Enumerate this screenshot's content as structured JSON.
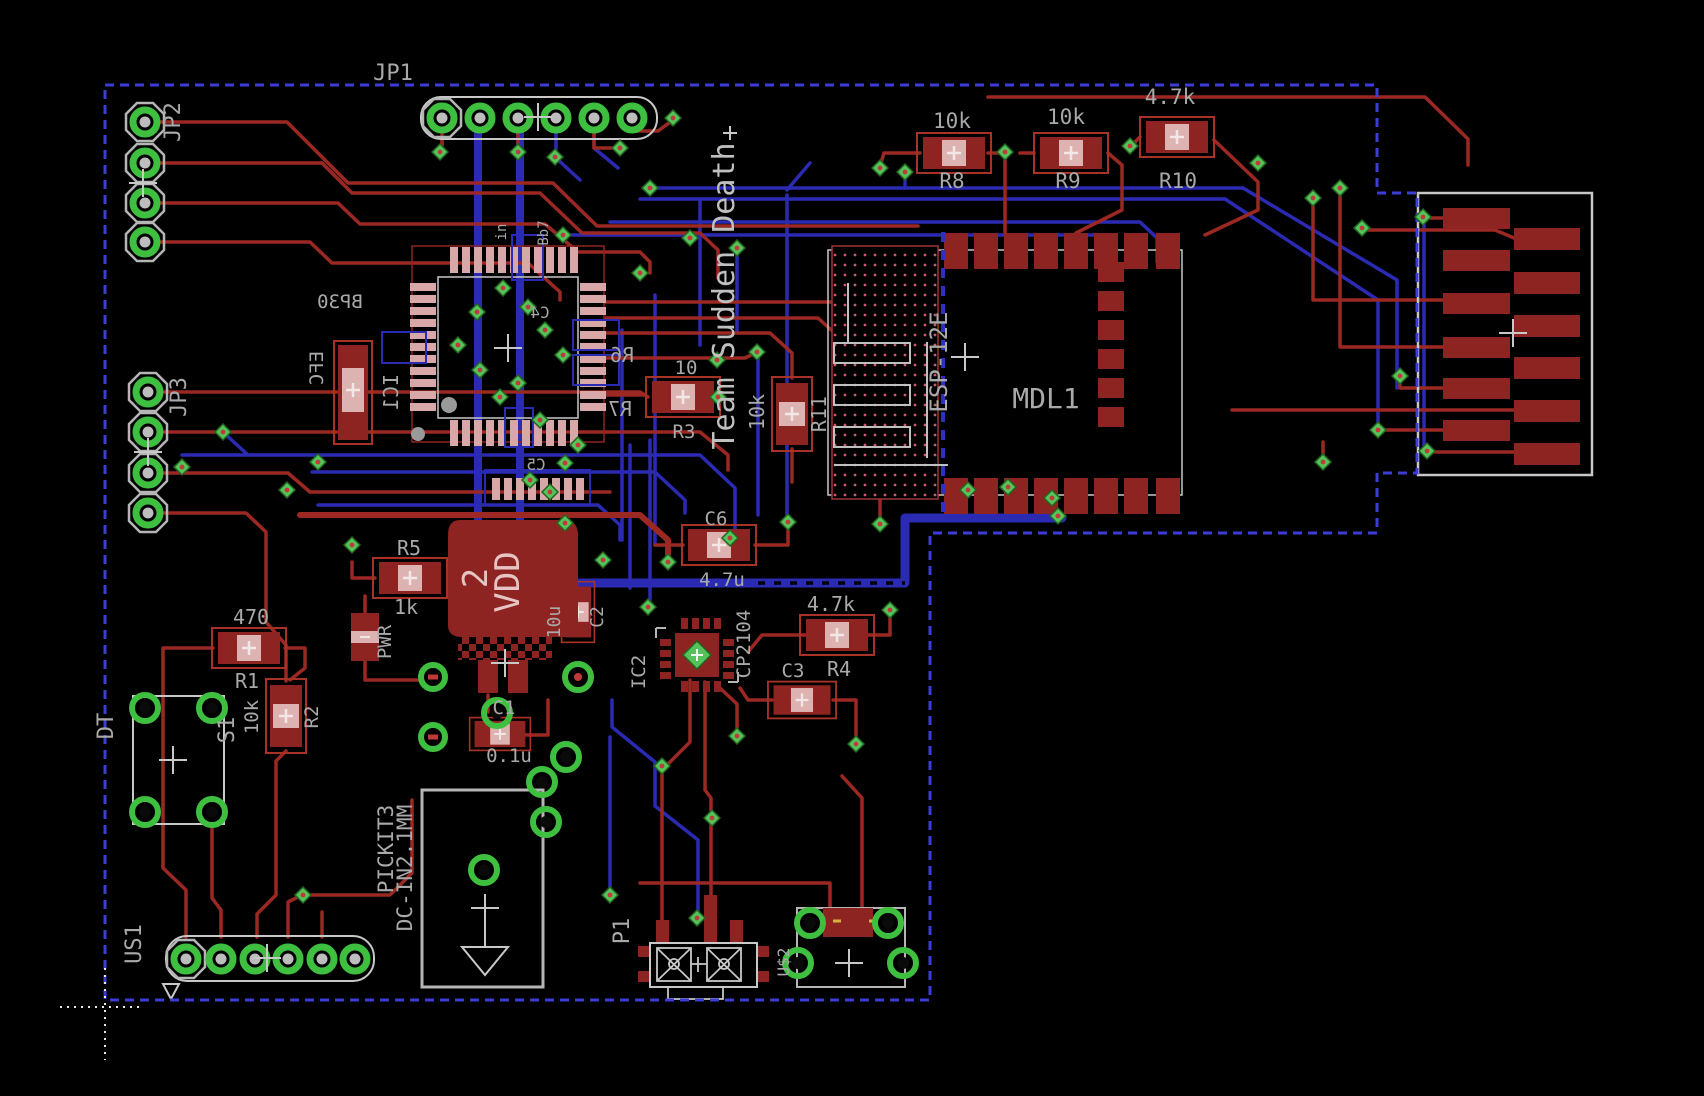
{
  "labels": {
    "jp1": "JP1",
    "jp2": "JP2",
    "jp3": "JP3",
    "r1_val": "470",
    "r1": "R1",
    "r2_val": "10k",
    "r2": "R2",
    "r3_val": "10",
    "r3": "R3",
    "r4_val": "4.7k",
    "r4": "R4",
    "r5": "R5",
    "r5_val": "1k",
    "r6": "R6",
    "r7": "R7",
    "r8_val": "10k",
    "r8": "R8",
    "r9_val": "10k",
    "r9": "R9",
    "r10_val": "4.7k",
    "r10": "R10",
    "r11_val": "10k",
    "r11": "R11",
    "c1": "C1",
    "c1_val": "0.1u",
    "c2_val": "10u",
    "c2": "C2",
    "c3": "C3",
    "c4": "C4",
    "c5": "C5",
    "c6": "C6",
    "c6_val": "4.7u",
    "ic1": "IC1",
    "ic1_pkg": "EFC",
    "ic1_pkg2": "BP30",
    "ic2": "IC2",
    "ic2_part": "CP2104",
    "esp": "ESP-12E",
    "mdl": "MDL1",
    "team": "Team Sudden Death",
    "vdd": "VDD",
    "vdd_pin": "2",
    "pwr": "PWR",
    "s1": "S1",
    "dt": "DT",
    "us1": "US1",
    "pickit": "PICKIT3",
    "dcin": "DC-IN2.1MM",
    "p1": "P1",
    "u2": "U$2",
    "tiny_in": "in",
    "tiny_bb": "Bb7"
  },
  "colors": {
    "board_bg": "#000000",
    "top_copper": "#9b2823",
    "bottom_copper": "#2a2ab2",
    "component_red": "#8e2421",
    "pad_pale": "#dcb3b0",
    "pad_green": "#3fbf3f",
    "silkscreen": "#c8c8c8",
    "outline_dashed": "#3c3cd6",
    "text_gray": "#a9a9a9"
  }
}
